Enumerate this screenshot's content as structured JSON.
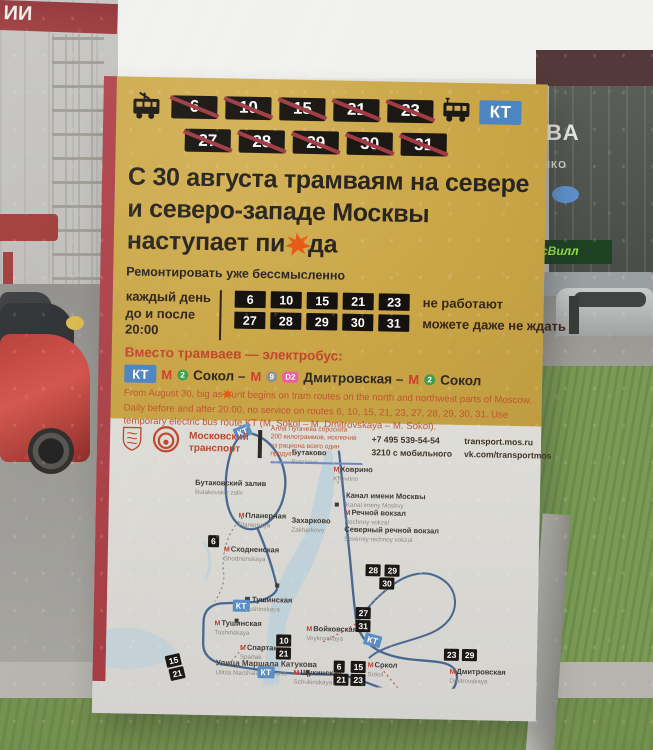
{
  "colors": {
    "poster_yellow": "#c9a546",
    "stripe_red": "#b0454b",
    "badge_black": "#1b1713",
    "strike_red": "#a13c45",
    "kt_blue": "#4d85c0",
    "accent_red": "#c2462e",
    "metro_red": "#d23b2e",
    "line2_green": "#3f9e4c",
    "line9_gray": "#919191",
    "d2_pink": "#ef5da0",
    "map_line_blue": "#49688f",
    "water_blue": "#b7cfdb",
    "splat_orange": "#e65a17"
  },
  "background": {
    "left_sign": "ИИ",
    "right_sign_big": "ВА",
    "right_sign_small": "ЧКО",
    "store_sign": "сВилл"
  },
  "poster": {
    "routes_row1": [
      "6",
      "10",
      "15",
      "21",
      "23"
    ],
    "routes_row2": [
      "27",
      "28",
      "29",
      "30",
      "31"
    ],
    "kt": "КТ",
    "headline": {
      "line1": "С 30 августа трамваям на севере",
      "line2": "и северо-западе Москвы",
      "line3_pre": "наступает пи",
      "line3_post": "да"
    },
    "subheadline": "Ремонтировать уже бессмысленно",
    "schedule": {
      "label1": "каждый день",
      "label2": "до и после",
      "label3": "20:00",
      "note1": "не работают",
      "note2": "можете даже не ждать"
    },
    "electrobus": {
      "heading": "Вместо трамваев — электробус:",
      "kt": "КТ",
      "m": "М",
      "line2": "2",
      "line9": "9",
      "d2": "D2",
      "seg1": "Сокол –",
      "seg2": "Дмитровская –",
      "seg3": "Сокол"
    },
    "english": {
      "pre": "From August 30, big as",
      "post": "unt begins on tram routes on the north and northwest parts of Moscow. Daily before and after 20:00, no service on routes 6, 10, 15, 21, 23, 27, 28, 29, 30, 31. Use temporary electric bus route KT (M. Sokol – M. Dmitrovskaya – M. Sokol)."
    },
    "footer": {
      "brand1": "Московский",
      "brand2": "транспорт",
      "qr1": "Алла Пугачева сбросила",
      "qr2": "200 килограммов, исключив",
      "qr3": "из рациона всего один продукт!",
      "phone1": "+7 495 539-54-54",
      "phone2": "3210 с мобильного",
      "web1": "transport.mos.ru",
      "web2": "vk.com/transportmos"
    }
  },
  "map": {
    "metro_m": "М",
    "stations": [
      {
        "ru": "Бутаково",
        "en": "Butakovo"
      },
      {
        "ru": "Ховрино",
        "en": "Khovrino"
      },
      {
        "ru": "Канал имени Москвы",
        "en": "Kanal imeny Moskvy"
      },
      {
        "ru": "Бутаковский залив",
        "en": "Butakovskiy zaliv"
      },
      {
        "ru": "Планерная",
        "en": "Planernaya"
      },
      {
        "ru": "Захарково",
        "en": "Zakharkovo"
      },
      {
        "ru": "Речной вокзал",
        "en": "Rechnoy vokzal"
      },
      {
        "ru": "Северный речной вокзал",
        "en": "Severniy rechnoy vokzal"
      },
      {
        "ru": "Сходненская",
        "en": "Shodnenskaya"
      },
      {
        "ru": "Тушинская",
        "en": "Tushinskaya"
      },
      {
        "ru": "Тушинская",
        "en": "Tushinskaya"
      },
      {
        "ru": "Спартак",
        "en": "Spartak"
      },
      {
        "ru": "Улица Маршала Катукова",
        "en": "Ulitsa Marshala Katukova"
      },
      {
        "ru": "Щукинская",
        "en": "Schukinskaya"
      },
      {
        "ru": "Войковская",
        "en": "Voykovskaya"
      },
      {
        "ru": "Сокол",
        "en": "Sokol"
      },
      {
        "ru": "Дмитровская",
        "en": "Dmitrovskaya"
      }
    ],
    "badges": {
      "kt": "КТ",
      "g1": [
        "6"
      ],
      "g2": [
        "28",
        "29",
        "30"
      ],
      "g3": [
        "27",
        "31"
      ],
      "g4": [
        "10",
        "21"
      ],
      "g5": [
        "15",
        "21"
      ],
      "g6": [
        "6",
        "15",
        "21",
        "23"
      ],
      "g7": [
        "23",
        "29"
      ]
    }
  }
}
